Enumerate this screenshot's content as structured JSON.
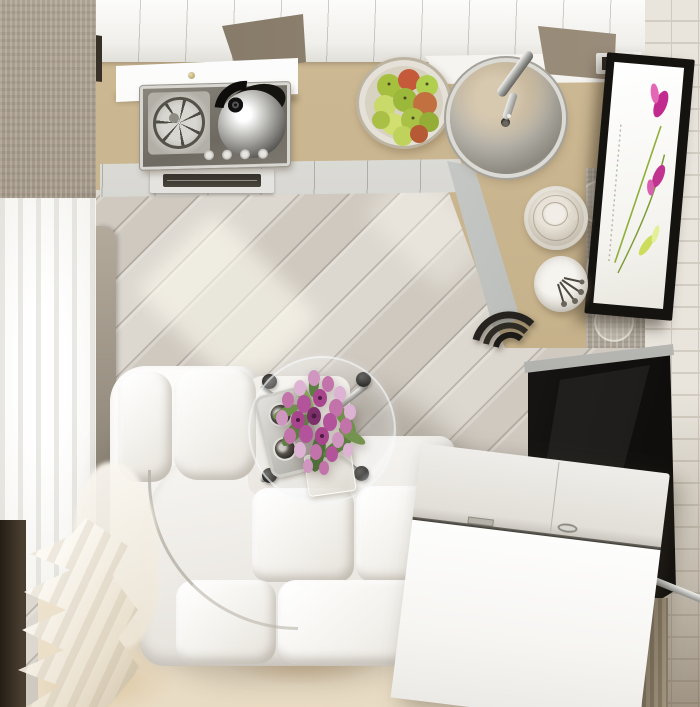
{
  "meta": {
    "title": "Top-down 3D render of a small studio apartment with kitchen and living area",
    "type": "interior-render",
    "view": "plan-top-down",
    "text_content": "none"
  },
  "palette": {
    "countertop_beige": "#c6b28b",
    "floor_wood_light": "#d9d4cc",
    "floor_plank_gap": "#7a7166",
    "rug_cream": "#eee3cf",
    "rug_patch_brown": "#b98f5e",
    "cabinet_white": "#f0efeb",
    "counter_edge_gray": "#c8c8c3",
    "wall_taupe": "#a79c8b",
    "brick_wall_white": "#e9e5dd",
    "sofa_white": "#f3f1ec",
    "tv_dark": "#141210",
    "chrome": "#b9b9b5",
    "tulip_pink": "#c273aa",
    "tulip_deep": "#a8458d",
    "leaf_green": "#5e7f42",
    "apple_green": "#a6bf3e",
    "apple_red": "#c45a39",
    "curtain_cream": "#fbf8f2",
    "sill_dark_brown": "#241e16"
  },
  "objects": [
    {
      "name": "wood-floor",
      "desc": "light gray diagonal plank flooring"
    },
    {
      "name": "area-rug",
      "desc": "beige rug with worn brown patches at bottom"
    },
    {
      "name": "kitchen-counter",
      "desc": "L-shaped beige countertop along top and right"
    },
    {
      "name": "counter-front-band",
      "desc": "light gray counter base band with vent grill"
    },
    {
      "name": "upper-cabinets",
      "desc": "white cabinet band along top edge"
    },
    {
      "name": "stove-cooktop",
      "desc": "stainless cooktop with burner grate, chrome kettle, 4 knobs"
    },
    {
      "name": "fruit-basket",
      "desc": "wire basket with green and red apples"
    },
    {
      "name": "round-sink",
      "desc": "round stainless sink with faucet"
    },
    {
      "name": "plate-stack",
      "desc": "stacked saucers with cup"
    },
    {
      "name": "utensil-cup",
      "desc": "white cup holding spoons"
    },
    {
      "name": "flower-artwork",
      "desc": "dark-framed vertical print with magenta flowers"
    },
    {
      "name": "white-brick-wall",
      "desc": "white brick wall strip on the right"
    },
    {
      "name": "window-curtains",
      "desc": "sheer white curtains pooling on floor at lower left"
    },
    {
      "name": "corner-sofa",
      "desc": "white leather L-shaped corner sofa"
    },
    {
      "name": "coffee-table",
      "desc": "round glass table, chrome legs with black feet"
    },
    {
      "name": "tulip-bouquet",
      "desc": "pink tulip bouquet in glass vase on tray with two cups"
    },
    {
      "name": "storage-chest",
      "desc": "white storage chest / TV bench lower right"
    },
    {
      "name": "tv-panel",
      "desc": "large dark flat panel with chrome trim lower right"
    },
    {
      "name": "bar-stool",
      "desc": "dark curved stool at counter corner"
    }
  ]
}
